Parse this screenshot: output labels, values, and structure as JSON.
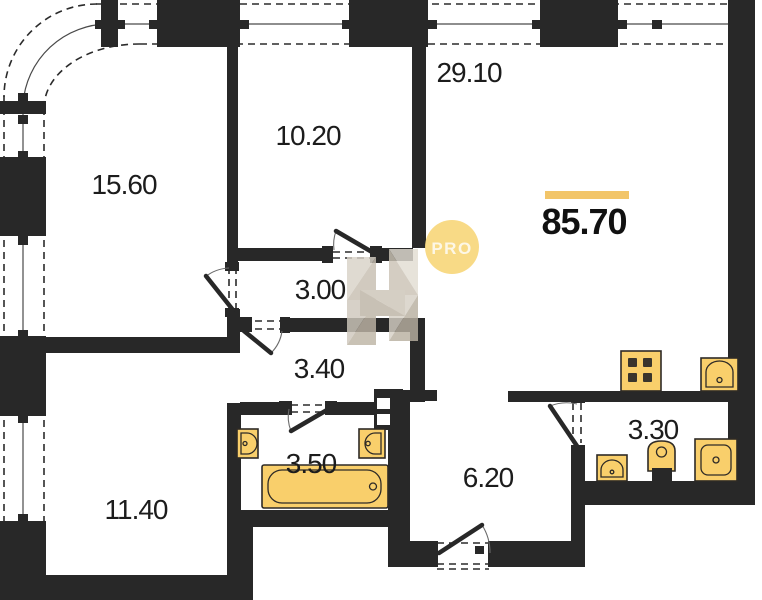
{
  "plan": {
    "total_area": {
      "value": "85.70"
    },
    "rooms": [
      {
        "area": "15.60"
      },
      {
        "area": "10.20"
      },
      {
        "area": "29.10"
      },
      {
        "area": "3.00"
      },
      {
        "area": "3.40"
      },
      {
        "area": "3.50"
      },
      {
        "area": "11.40"
      },
      {
        "area": "6.20"
      },
      {
        "area": "3.30"
      }
    ]
  },
  "watermark": {
    "logo_text": "PRO"
  },
  "fixtures": [
    "bathtub",
    "sink",
    "toilet",
    "shower-tray",
    "cooktop",
    "kitchen-sink",
    "ventilation-shaft"
  ],
  "colors": {
    "wall": "#282828",
    "line": "#4a4a4a",
    "dash": "#2b2b2b",
    "fixture": "#F9CF6B",
    "fixtureStroke": "#2E2A26",
    "accentBar": "#F2C569",
    "watermarkCircle": "#F7D77D",
    "text": "#1C1C1C"
  }
}
